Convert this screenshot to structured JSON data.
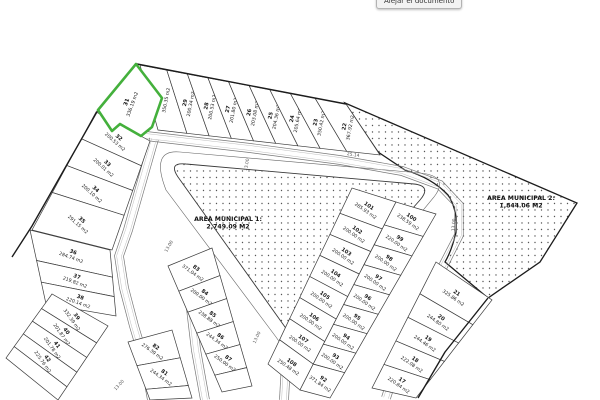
{
  "viewer": {
    "tooltip": "Alejar el documento"
  },
  "map": {
    "municipal_areas": [
      {
        "title": "AREA MUNICIPAL 1:",
        "area": "2,749.09 M2"
      },
      {
        "title": "AREA MUNICIPAL 2:",
        "area": "1,844.06 M2"
      }
    ],
    "highlighted_lot": {
      "number": "31",
      "area": "336.19 m2",
      "outline_color": "#44b03c"
    },
    "strips": {
      "top_row": [
        [
          "30",
          "350.35 m2"
        ],
        [
          "29",
          "200.34 m2"
        ],
        [
          "28",
          "200.53 m2"
        ],
        [
          "27",
          "201.80 m2"
        ],
        [
          "26",
          "203.08 m2"
        ],
        [
          "25",
          "204.36 m2"
        ],
        [
          "24",
          "205.64 m2"
        ],
        [
          "23",
          "350.42 m2"
        ],
        [
          "22",
          "367.92 m2"
        ]
      ],
      "left_col_upper": [
        [
          "32",
          "200.53 m2"
        ],
        [
          "33",
          "200.01 m2"
        ],
        [
          "34",
          "200.10 m2"
        ],
        [
          "35",
          "291.15 m2"
        ]
      ],
      "left_col_lower": [
        [
          "36",
          "284.74 m2"
        ],
        [
          "37",
          "219.82 m2"
        ],
        [
          "38",
          "220.14 m2"
        ]
      ],
      "southwest_strip": [
        [
          "39",
          "332.39 m2"
        ],
        [
          "40",
          "201.87 m2"
        ],
        [
          "41",
          "201.78 m2"
        ],
        [
          "42",
          "225.76 m2"
        ],
        [
          "",
          ""
        ]
      ],
      "block_sw": [
        [
          "83",
          "371.04 m2"
        ],
        [
          "84",
          "200.00 m2"
        ],
        [
          "85",
          "238.88 m2"
        ],
        [
          "86",
          "244.34 m2"
        ],
        [
          "87",
          "250.00 m2"
        ],
        [
          "",
          ""
        ]
      ],
      "col_81_82": [
        [
          "82",
          "276.39 m2"
        ],
        [
          "81",
          "244.34 m2"
        ],
        [
          "",
          ""
        ]
      ],
      "center_block_left": [
        [
          "101",
          "285.93 m2"
        ],
        [
          "102",
          "200.00 m2"
        ],
        [
          "103",
          "200.00 m2"
        ],
        [
          "104",
          "200.00 m2"
        ],
        [
          "105",
          "200.00 m2"
        ],
        [
          "106",
          "200.00 m2"
        ],
        [
          "107",
          "200.00 m2"
        ],
        [
          "108",
          "250.48 m2"
        ]
      ],
      "center_block_right": [
        [
          "100",
          "238.59 m2"
        ],
        [
          "99",
          "220.00 m2"
        ],
        [
          "98",
          "200.00 m2"
        ],
        [
          "97",
          "200.00 m2"
        ],
        [
          "96",
          "200.00 m2"
        ],
        [
          "95",
          "200.00 m2"
        ],
        [
          "94",
          "200.00 m2"
        ],
        [
          "93",
          "200.00 m2"
        ],
        [
          "92",
          "371.84 m2"
        ]
      ],
      "east_col": [
        [
          "21",
          "325.86 m2"
        ],
        [
          "20",
          "244.80 m2"
        ],
        [
          "19",
          "244.46 m2"
        ],
        [
          "18",
          "222.08 m2"
        ],
        [
          "17",
          "220.84 m2"
        ]
      ]
    },
    "road_dimensions": [
      "13.00",
      "13.00",
      "13.00",
      "13.00",
      "13.00",
      "25.14"
    ]
  }
}
